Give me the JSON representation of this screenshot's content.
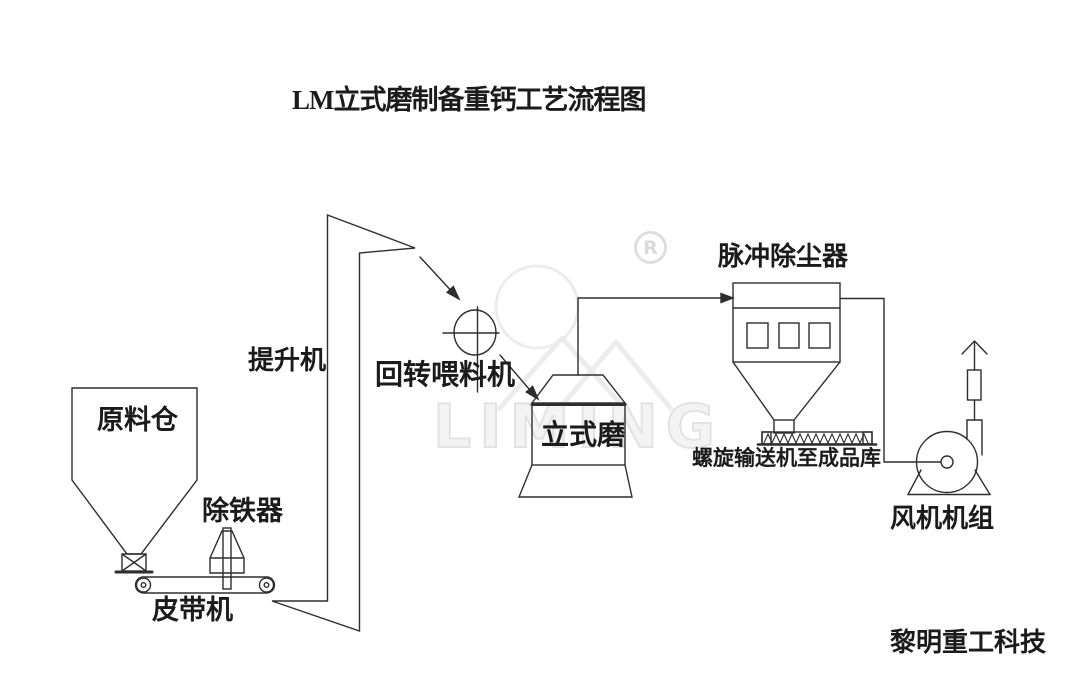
{
  "title": "LM立式磨制备重钙工艺流程图",
  "company": "黎明重工科技",
  "watermark": {
    "logo_text": "LIMING",
    "registered_letter": "R"
  },
  "equipment": {
    "raw_material_silo": "原料仓",
    "iron_remover": "除铁器",
    "belt_conveyor": "皮带机",
    "bucket_elevator": "提升机",
    "rotary_feeder": "回转喂料机",
    "vertical_mill": "立式磨",
    "pulse_dust_collector": "脉冲除尘器",
    "screw_conveyor": "螺旋输送机至成品库",
    "fan_unit": "风机机组"
  },
  "colors": {
    "line": "#2e2e2e",
    "text": "#1b1b1b",
    "watermark": "#e7e7e7",
    "background": "#ffffff"
  }
}
